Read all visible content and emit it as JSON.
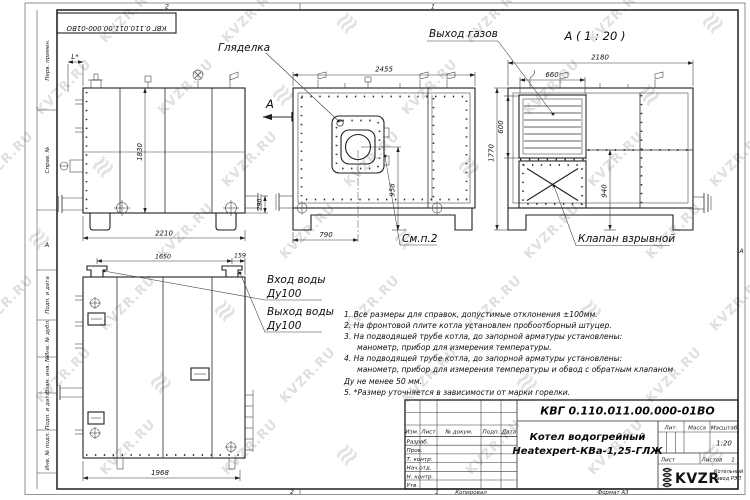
{
  "watermark": {
    "text": "KVZR.RU",
    "glyph": "≋"
  },
  "frame": {
    "doc_number_rotated": "КВГ 0.110.011.00.000-01ВО",
    "zone_top_left": "2",
    "zone_top_right": "1",
    "zone_bottom_left": "2",
    "zone_bottom_right": "1",
    "zone_side_left": "А",
    "zone_side_right": "А",
    "stamps": [
      "Перв. примен.",
      "Справ. №",
      "Подп. и дата",
      "Инв. № дубл.",
      "Взам. инв. №",
      "Подп. и дата",
      "Инв. № подл."
    ]
  },
  "labels": {
    "sight_glass": "Гляделка",
    "gas_outlet": "Выход газов",
    "section_view_title": "А ( 1 : 20 )",
    "section_arrow": "А",
    "explosion_valve": "Клапан взрывной",
    "see_note": "См.п.2",
    "water_inlet": "Вход воды",
    "water_inlet_dn": "Ду100",
    "water_outlet": "Выход воды",
    "water_outlet_dn": "Ду100",
    "l_star": "L*"
  },
  "dimensions": {
    "front_width": "2455",
    "rear_width": "2180",
    "gas_outlet_width": "660",
    "gas_outlet_height": "600",
    "overall_height": "1770",
    "side_height": "1830",
    "side_length": "2210",
    "valve_height": "940",
    "burner_axis_height": "958",
    "burner_axis_offset": "790",
    "pipe_height": "290",
    "top_width_main": "1650",
    "top_width_edge": "159",
    "top_length": "1968"
  },
  "notes": {
    "lines": [
      "1. Все размеры для справок, допустимые отклонения ±100мм.",
      "2. На фронтовой плите котла установлен пробоотборный штуцер.",
      "3. На подводящей трубе котла, до запорной арматуры установлены:",
      "манометр, прибор для измерения температуры.",
      "4. На подводящей трубе котла, до запорной арматуры установлены:",
      "манометр, прибор для измерения температуры и обвод с обратным клапаном",
      "Ду не менее 50 мм.",
      "5. *Размер уточняется в зависимости от марки горелки."
    ]
  },
  "title_block": {
    "doc_number": "КВГ 0.110.011.00.000-01ВО",
    "product_name_line1": "Котел водогрейный",
    "product_name_line2": "Heatexpert-КВа-1,25-ГЛЖ",
    "col_izm": "Изм.",
    "col_list": "Лист",
    "col_doc": "№ докум.",
    "col_podp": "Подп.",
    "col_data": "Дата",
    "row_razrab": "Разраб.",
    "row_prov": "Пров.",
    "row_tkontr": "Т. контр.",
    "row_nachotd": "Нач.отд.",
    "row_nkontr": "Н. контр.",
    "row_utv": "Утв.",
    "lit_label": "Лит.",
    "massa_label": "Масса",
    "masshtab_label": "Масштаб",
    "masshtab_value": "1:20",
    "list_label": "Лист",
    "listov_label": "Листов",
    "listov_value": "1",
    "logo_text": "KVZR",
    "logo_sub1": "Котельный",
    "logo_sub2": "завод РЭП",
    "kopiroval": "Копировал",
    "format": "Формат А3"
  }
}
